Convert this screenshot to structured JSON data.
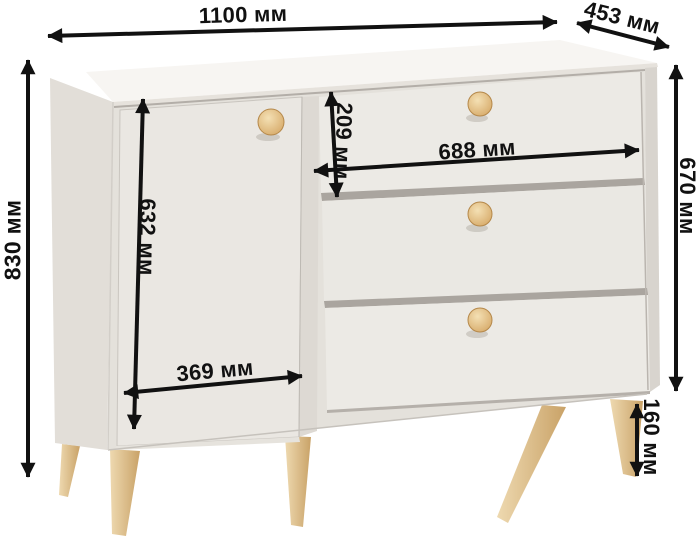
{
  "figure": {
    "kind": "furniture dimension diagram",
    "unit": "мм"
  },
  "dimensions": {
    "overall_width": {
      "name": "overall width",
      "value": 1100,
      "unit": "мм",
      "label": "1100 мм"
    },
    "depth": {
      "name": "top depth",
      "value": 453,
      "unit": "мм",
      "label": "453 мм"
    },
    "overall_height": {
      "name": "overall height",
      "value": 830,
      "unit": "мм",
      "label": "830 мм"
    },
    "body_height": {
      "name": "body height",
      "value": 670,
      "unit": "мм",
      "label": "670 мм"
    },
    "door_height": {
      "name": "door height",
      "value": 632,
      "unit": "мм",
      "label": "632 мм"
    },
    "door_width": {
      "name": "door width",
      "value": 369,
      "unit": "мм",
      "label": "369 мм"
    },
    "drawer_height": {
      "name": "drawer front height",
      "value": 209,
      "unit": "мм",
      "label": "209 мм"
    },
    "drawer_width": {
      "name": "drawer front width",
      "value": 688,
      "unit": "мм",
      "label": "688 мм"
    },
    "leg_height": {
      "name": "leg height",
      "value": 160,
      "unit": "мм",
      "label": "160 мм"
    }
  },
  "colors": {
    "background": "#ffffff",
    "annotation": "#111111",
    "body_front": "#edebe6",
    "body_top": "#f7f5f2",
    "body_side": "#e2ded8",
    "door": "#eae7e2",
    "wood_leg": "#dfbd89",
    "wood_knob": "#e3b878"
  }
}
